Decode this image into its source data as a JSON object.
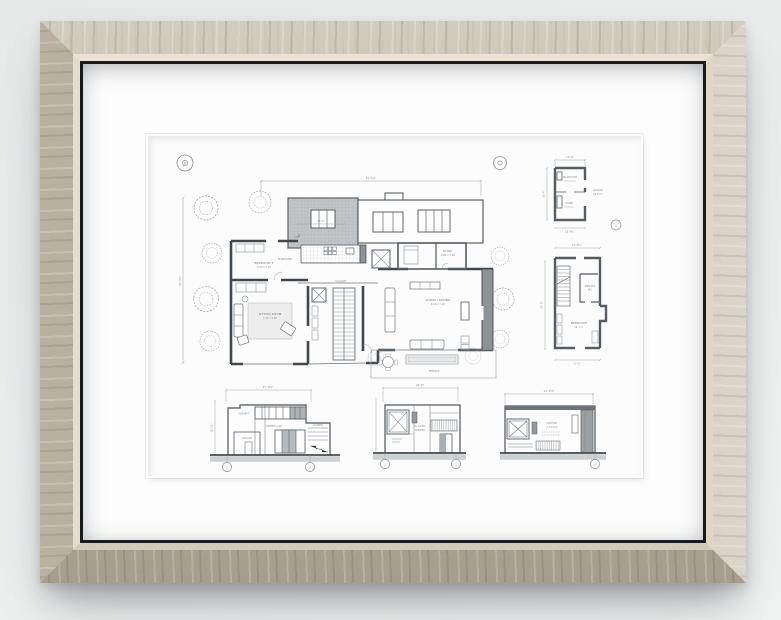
{
  "palette": {
    "wall": "#ebedec",
    "frame_light": "#d2cbbe",
    "frame_mid": "#b2a99b",
    "frame_dark": "#a79d8f",
    "lip": "#e4dccd",
    "fillet": "#191a1d",
    "mat": "#fdfdfd",
    "paper": "#fbfcfb",
    "ink": "#41474d",
    "ink_light": "#9aa0a6",
    "wall_poche": "#8d9398",
    "roof_hatch": "#c2c5c7",
    "ground": "#ccd0d1"
  },
  "markers": {
    "site_datum": "0",
    "site_datum_b": "0",
    "garage_datum": "0",
    "e1_left": "1",
    "e1_right": "4",
    "e2_left": "2",
    "e2_right": "3",
    "e3_right": "6"
  },
  "site_plan": {
    "dim_top": "31'-5¾\"",
    "dim_left": "52'-10\"",
    "dim_skylight": "12'-2\"",
    "labels": {
      "bedroom": "BEDROOM 2",
      "bedroom_sub": "3.60 x 4.20",
      "wardrobe": "WARDROBE",
      "hall": "HALLWAY",
      "sitting": "SITTING ROOM",
      "sitting_sub": "4.10 x 4.60",
      "living": "LIVING / DINING",
      "living_sub": "6.20 x 7.40",
      "study": "STUDY",
      "study_sub": "2.80 x 3.40",
      "terrace": "TERRACE"
    }
  },
  "garage_plan": {
    "dim_top": "19'-8\"",
    "dim_bottom": "18'-9¾\"",
    "dim_left": "16'-4\"",
    "labels": {
      "workshop": "WORKSHOP",
      "store": "STORE",
      "garage": "GARAGE",
      "garage_sub": "19.6 m²"
    }
  },
  "bedroom_plan": {
    "dim_top": "14'-6½\"",
    "dim_left": "21'-4\"",
    "dim_bottom": "13'-2\"",
    "labels": {
      "ensuite": "ENSUITE",
      "ensuite_sub": "WC",
      "bedroom": "BEDROOM",
      "bedroom_sub": "16.4 m²"
    }
  },
  "elevations": {
    "e1": {
      "dim_top": "37'-0¼\"",
      "dim_left": "11'-10\"",
      "labels": {
        "parapet": "PARAPET",
        "cladding": "TIMBER CLAD",
        "garage_door": "GARAGE",
        "screen": "SCREEN"
      }
    },
    "e2": {
      "dim_top": "23'-8\"",
      "labels": {
        "glazing": "GLAZING",
        "render": "RENDER"
      }
    },
    "e3": {
      "dim_top": "21'-9½\"",
      "labels": {
        "carport": "CARPORT",
        "carport_sub": "2.70 CLG"
      }
    }
  }
}
